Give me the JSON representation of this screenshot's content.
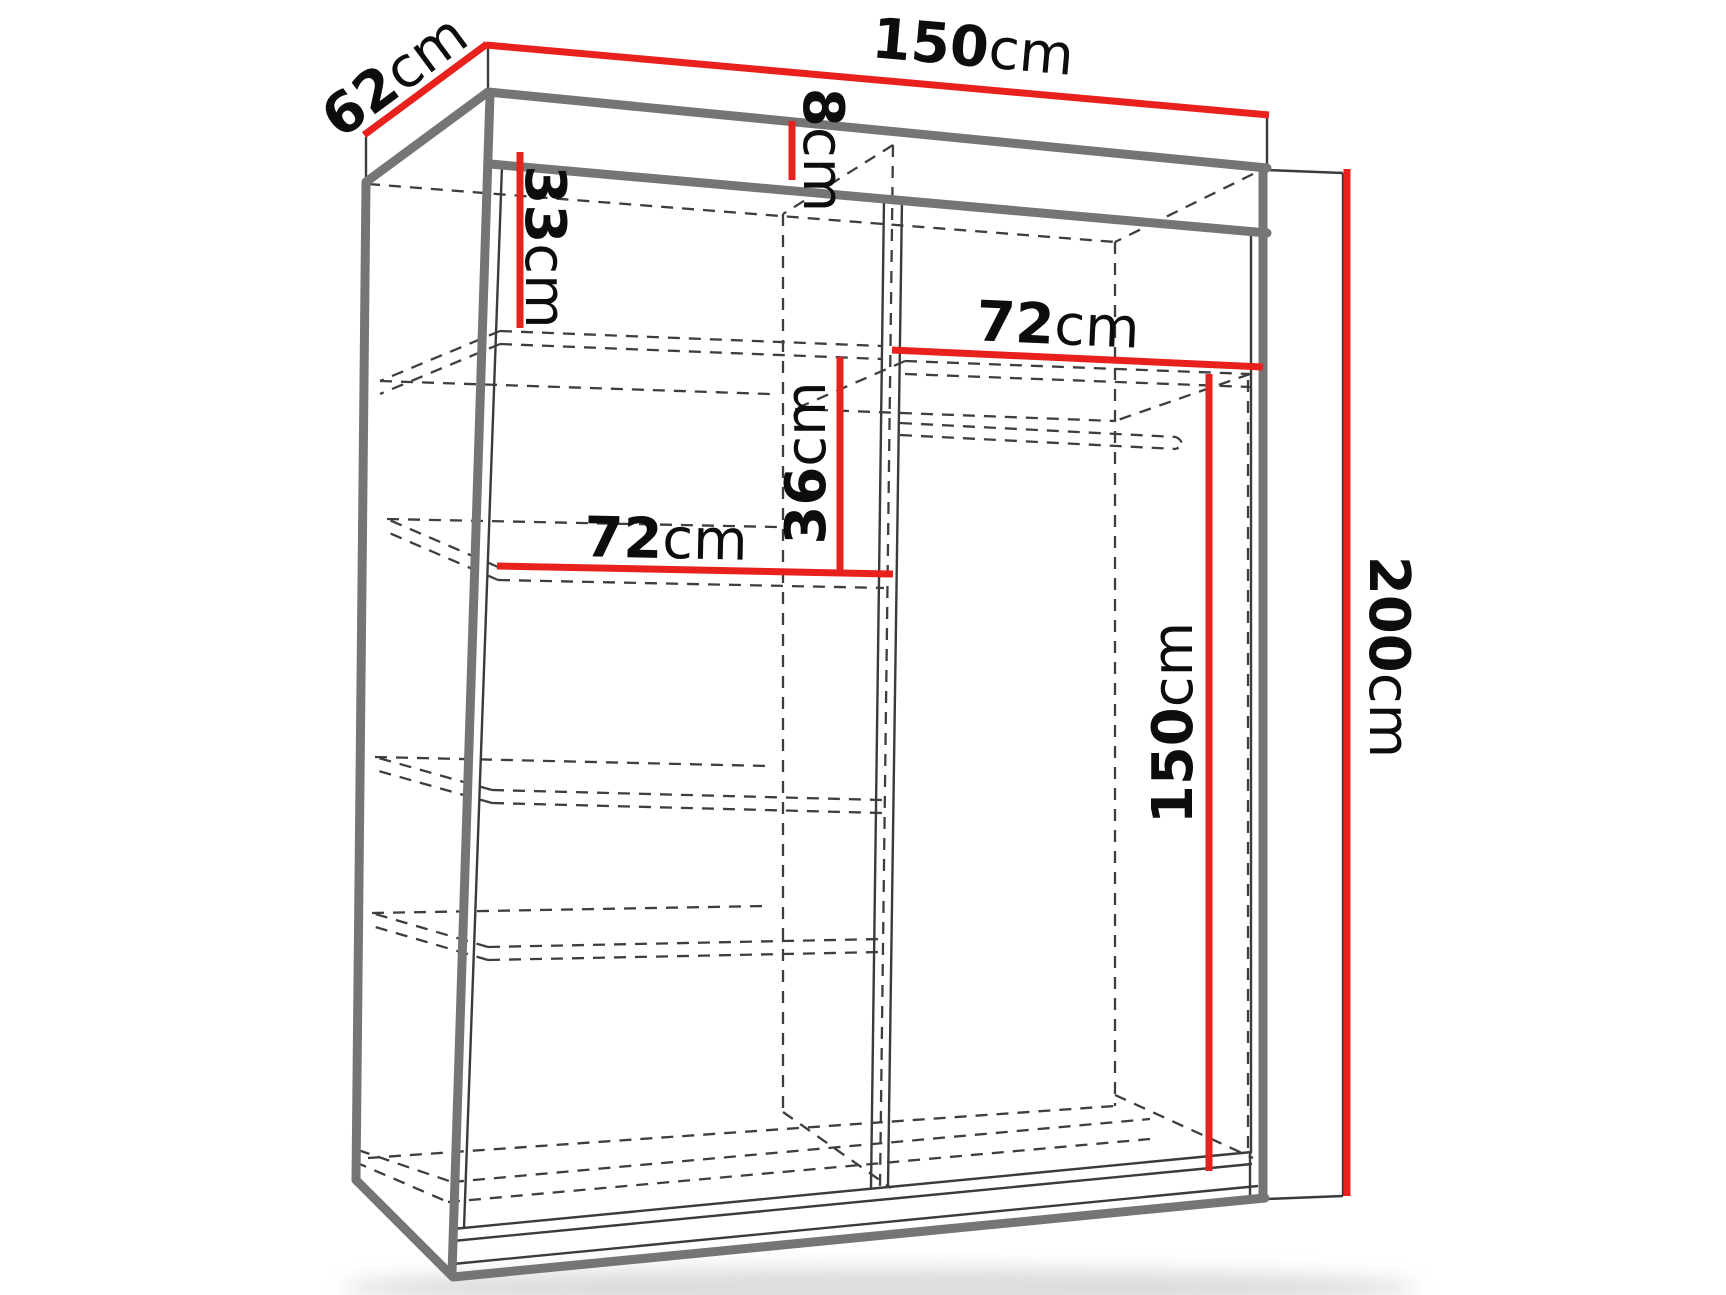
{
  "diagram": {
    "title": "Sliding-door wardrobe dimensions line drawing",
    "unit": "cm",
    "accent_color": "#e8211d",
    "thin_line_color": "#3b3b3b",
    "thick_edge_color": "#757575",
    "dashed_line_color": "#3e3e3e",
    "dimensions": {
      "width_top": {
        "num": "150",
        "unit": "cm"
      },
      "depth": {
        "num": "62",
        "unit": "cm"
      },
      "top_frame": {
        "num": "8",
        "unit": "cm"
      },
      "top_shelf_drop": {
        "num": "33",
        "unit": "cm"
      },
      "left_shelf_width": {
        "num": "72",
        "unit": "cm"
      },
      "shelf_gap": {
        "num": "36",
        "unit": "cm"
      },
      "right_shelf_width": {
        "num": "72",
        "unit": "cm"
      },
      "hanging_height": {
        "num": "150",
        "unit": "cm"
      },
      "total_height": {
        "num": "200",
        "unit": "cm"
      }
    },
    "structure": {
      "left_column_shelves": 4,
      "hanging_rail": true,
      "sliding_doors": 2
    }
  }
}
